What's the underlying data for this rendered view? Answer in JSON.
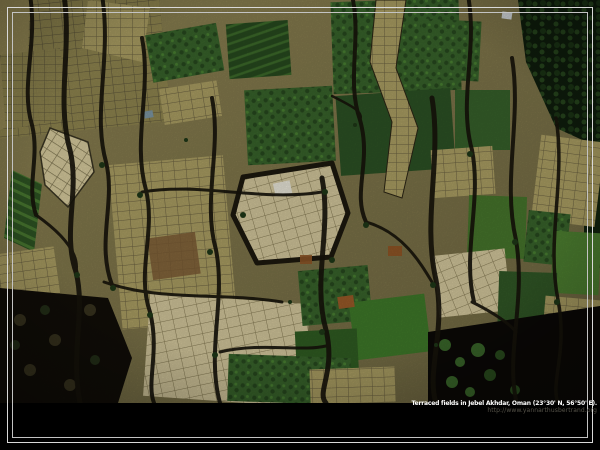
{
  "caption": {
    "title": "Terraced fields in Jebel Akhdar, Oman (23°30' N, 56°50' E).",
    "url": "http://www.yannarthusbertrand.org"
  },
  "colors": {
    "background": "#000000",
    "frame_line_outer": "#d9d9d9",
    "frame_line_inner": "#c3c3c3",
    "caption_title": "#ffffff",
    "caption_url": "#565349",
    "terrain_base_olive": "#8a8050",
    "field_tan": "#ab9e63",
    "field_pale": "#d6caa0",
    "field_green_dark": "#2e5423",
    "field_green_bright": "#3e7829",
    "palm_grove": "#0f1d0c",
    "ravine": "#17140b",
    "shadow_black": "#0b0906"
  }
}
